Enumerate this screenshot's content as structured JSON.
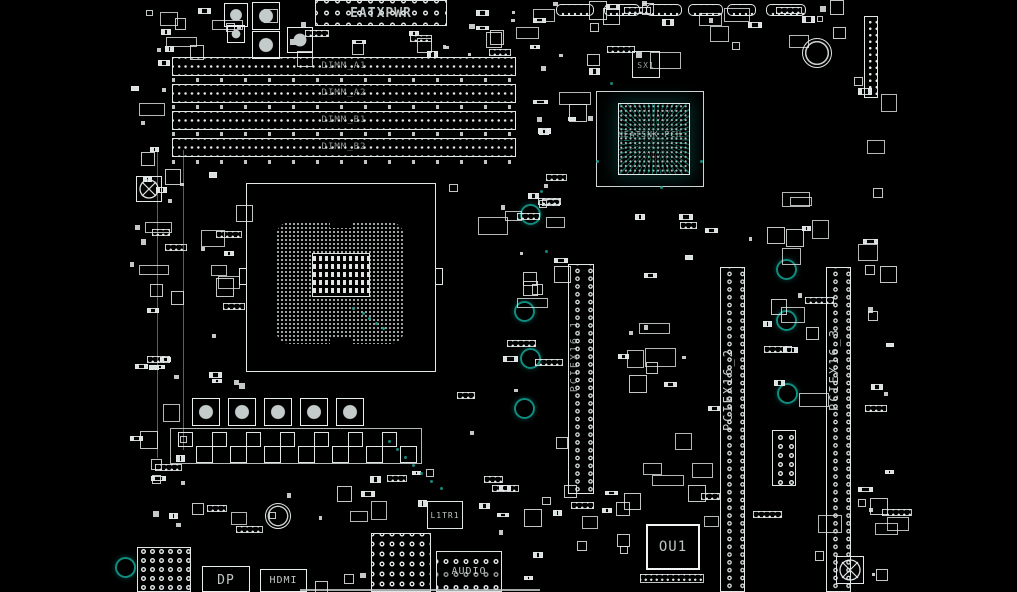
{
  "board": {
    "colors": {
      "background": "#000000",
      "outline": "#e2e7e7",
      "teal_accent": "#17a08e",
      "label": "#c8d2d0"
    }
  },
  "connectors": {
    "eatxpwr": "EATXPWR",
    "dimm_slots": [
      "DIMM_A1",
      "DIMM_A2",
      "DIMM_B1",
      "DIMM_B2"
    ],
    "pcie_slot_1": "PCIEX16_1",
    "pcie_slot_2": "PCIEX16_2",
    "pcie_slot_3": "PCIEX16_3",
    "dp": "DP",
    "hdmi": "HDMI",
    "audio": "AUDIO"
  },
  "ics": {
    "pch_label": "HEATSNK_PCH",
    "ou1": "OU1",
    "l1tr1": "L1TR1",
    "sx1": "SX1"
  },
  "mount_holes": [
    [
      529,
      213
    ],
    [
      523,
      310
    ],
    [
      529,
      357
    ],
    [
      523,
      407
    ],
    [
      785,
      268
    ],
    [
      785,
      319
    ],
    [
      786,
      392
    ],
    [
      124,
      566
    ]
  ]
}
